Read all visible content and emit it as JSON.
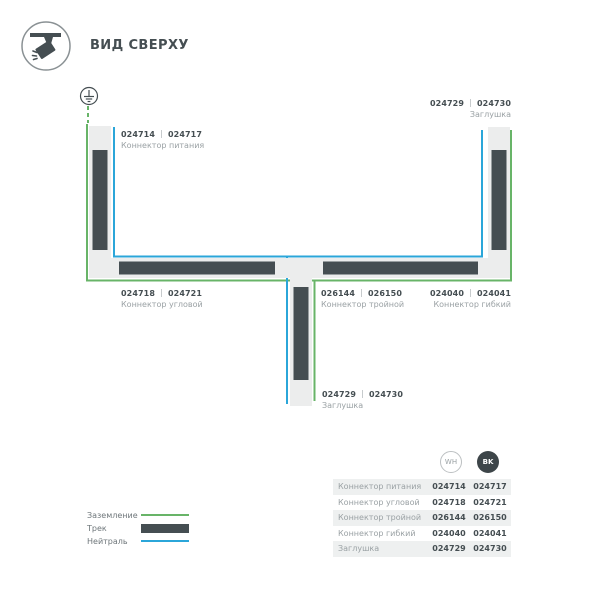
{
  "header": {
    "title": "ВИД СВЕРХУ",
    "icon": "track-spotlight-icon"
  },
  "colors": {
    "dark": "#454e52",
    "green": "#68b468",
    "blue": "#2ba6d9",
    "tracklight": "#eceded",
    "graytxt": "#9aa1a4"
  },
  "diagram": {
    "ground_icon": "earth-ground-icon",
    "labels": {
      "power": {
        "wh": "024714",
        "bk": "024717",
        "name": "Коннектор питания"
      },
      "endcap_top": {
        "wh": "024729",
        "bk": "024730",
        "name": "Заглушка"
      },
      "corner": {
        "wh": "024718",
        "bk": "024721",
        "name": "Коннектор угловой"
      },
      "triple": {
        "wh": "026144",
        "bk": "026150",
        "name": "Коннектор тройной"
      },
      "flexible": {
        "wh": "024040",
        "bk": "024041",
        "name": "Коннектор гибкий"
      },
      "endcap_bottom": {
        "wh": "024729",
        "bk": "024730",
        "name": "Заглушка"
      }
    }
  },
  "legend": {
    "items": [
      {
        "label": "Заземление",
        "type": "ground-line"
      },
      {
        "label": "Трек",
        "type": "track-bar"
      },
      {
        "label": "Нейтраль",
        "type": "neutral-line"
      }
    ]
  },
  "table": {
    "col_wh": "WH",
    "col_bk": "BK",
    "rows": [
      {
        "name": "Коннектор питания",
        "wh": "024714",
        "bk": "024717"
      },
      {
        "name": "Коннектор угловой",
        "wh": "024718",
        "bk": "024721"
      },
      {
        "name": "Коннектор тройной",
        "wh": "026144",
        "bk": "026150"
      },
      {
        "name": "Коннектор гибкий",
        "wh": "024040",
        "bk": "024041"
      },
      {
        "name": "Заглушка",
        "wh": "024729",
        "bk": "024730"
      }
    ]
  }
}
